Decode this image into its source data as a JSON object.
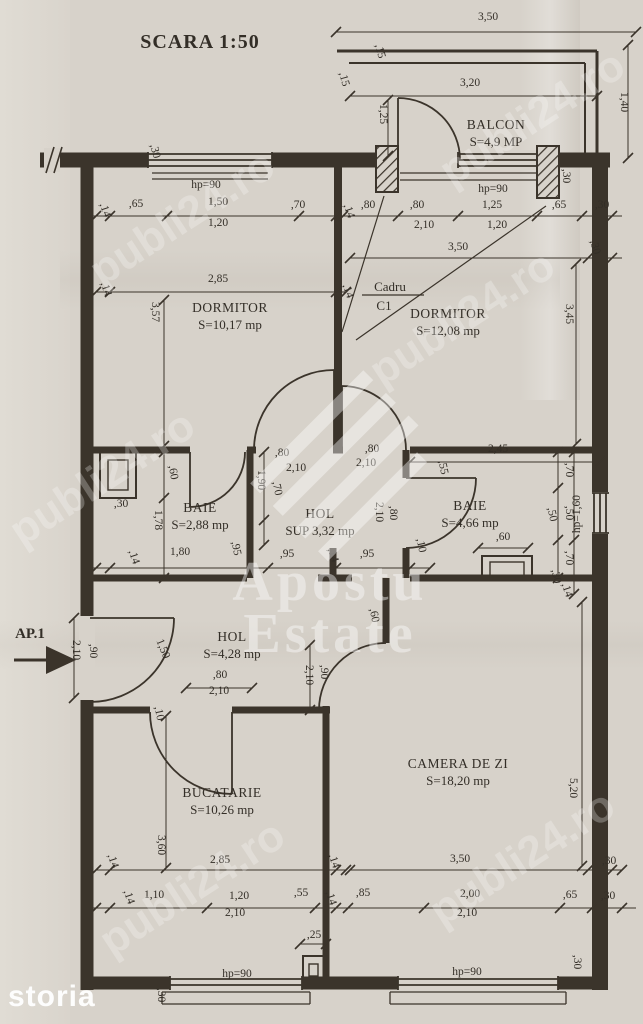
{
  "title": "SCARA 1:50",
  "entrance": {
    "label": "AP.1"
  },
  "frame_callout": {
    "line1": "Cadru",
    "line2": "C1"
  },
  "watermarks": {
    "portal": "publi24.ro",
    "agency_line1": "Apostu",
    "agency_line2": "Estate",
    "footer": "storia"
  },
  "colors": {
    "ink": "#3b342b",
    "paper": "#d7d2ca",
    "watermark": "#ffffff"
  },
  "rooms": [
    {
      "id": "balcon",
      "name": "BALCON",
      "area": "S=4,9 MP",
      "x": 496,
      "y": 129
    },
    {
      "id": "dormitor-1",
      "name": "DORMITOR",
      "area": "S=10,17 mp",
      "x": 230,
      "y": 312
    },
    {
      "id": "dormitor-2",
      "name": "DORMITOR",
      "area": "S=12,08 mp",
      "x": 448,
      "y": 318
    },
    {
      "id": "baie-1",
      "name": "BAIE",
      "area": "S=2,88 mp",
      "x": 200,
      "y": 512
    },
    {
      "id": "hol-1",
      "name": "HOL",
      "area": "SUP 3,32 mp",
      "x": 320,
      "y": 518
    },
    {
      "id": "baie-2",
      "name": "BAIE",
      "area": "S=4,66 mp",
      "x": 470,
      "y": 510
    },
    {
      "id": "hol-2",
      "name": "HOL",
      "area": "S=4,28 mp",
      "x": 232,
      "y": 641
    },
    {
      "id": "bucatarie",
      "name": "BUCATARIE",
      "area": "S=10,26 mp",
      "x": 222,
      "y": 797
    },
    {
      "id": "camera-de-zi",
      "name": "CAMERA DE ZI",
      "area": "S=18,20 mp",
      "x": 458,
      "y": 768
    }
  ],
  "dim_labels": [
    {
      "text": "3,50",
      "x": 488,
      "y": 20,
      "rot": 0
    },
    {
      "text": "1,40",
      "x": 621,
      "y": 102,
      "rot": 90
    },
    {
      "text": "3,20",
      "x": 470,
      "y": 86,
      "rot": 0
    },
    {
      "text": "1,25",
      "x": 380,
      "y": 114,
      "rot": 90
    },
    {
      "text": ",15",
      "x": 377,
      "y": 52,
      "rot": 75
    },
    {
      "text": ",15",
      "x": 341,
      "y": 80,
      "rot": 75
    },
    {
      "text": "hp=90",
      "x": 493,
      "y": 192,
      "rot": 0
    },
    {
      "text": "hp=90",
      "x": 206,
      "y": 188,
      "rot": 0
    },
    {
      "text": ",30",
      "x": 563,
      "y": 176,
      "rot": 90
    },
    {
      "text": ",30",
      "x": 152,
      "y": 152,
      "rot": 75
    },
    {
      "text": ",14",
      "x": 102,
      "y": 211,
      "rot": 72
    },
    {
      "text": ",65",
      "x": 136,
      "y": 207,
      "rot": 0
    },
    {
      "text": "1,50",
      "x": 218,
      "y": 205,
      "rot": 0
    },
    {
      "text": "1,20",
      "x": 218,
      "y": 226,
      "rot": 0
    },
    {
      "text": ",70",
      "x": 298,
      "y": 208,
      "rot": 0
    },
    {
      "text": ",14",
      "x": 346,
      "y": 212,
      "rot": 72
    },
    {
      "text": ",80",
      "x": 368,
      "y": 208,
      "rot": 0
    },
    {
      "text": ",80",
      "x": 417,
      "y": 208,
      "rot": 0
    },
    {
      "text": "2,10",
      "x": 424,
      "y": 228,
      "rot": 0
    },
    {
      "text": "1,25",
      "x": 492,
      "y": 208,
      "rot": 0
    },
    {
      "text": "1,20",
      "x": 497,
      "y": 228,
      "rot": 0
    },
    {
      "text": ",65",
      "x": 559,
      "y": 208,
      "rot": 0
    },
    {
      "text": ",30",
      "x": 602,
      "y": 208,
      "rot": 0
    },
    {
      "text": ",14",
      "x": 103,
      "y": 290,
      "rot": 72
    },
    {
      "text": "2,85",
      "x": 218,
      "y": 282,
      "rot": 0
    },
    {
      "text": ",14",
      "x": 345,
      "y": 292,
      "rot": 72
    },
    {
      "text": "3,50",
      "x": 458,
      "y": 250,
      "rot": 0
    },
    {
      "text": ",30",
      "x": 592,
      "y": 248,
      "rot": 75
    },
    {
      "text": "3,57",
      "x": 152,
      "y": 312,
      "rot": 90
    },
    {
      "text": "3,45",
      "x": 566,
      "y": 314,
      "rot": 90
    },
    {
      "text": ",60",
      "x": 170,
      "y": 473,
      "rot": 80
    },
    {
      "text": ",30",
      "x": 121,
      "y": 507,
      "rot": 0
    },
    {
      "text": "1,78",
      "x": 155,
      "y": 520,
      "rot": 90
    },
    {
      "text": ",14",
      "x": 131,
      "y": 558,
      "rot": 72
    },
    {
      "text": "1,80",
      "x": 180,
      "y": 555,
      "rot": 0
    },
    {
      "text": ",95",
      "x": 233,
      "y": 549,
      "rot": 78
    },
    {
      "text": ",95",
      "x": 287,
      "y": 557,
      "rot": 0
    },
    {
      "text": ",14",
      "x": 330,
      "y": 556,
      "rot": 72
    },
    {
      "text": ",95",
      "x": 367,
      "y": 557,
      "rot": 0
    },
    {
      "text": ",10",
      "x": 418,
      "y": 546,
      "rot": 78
    },
    {
      "text": "1,90",
      "x": 258,
      "y": 480,
      "rot": 90
    },
    {
      "text": ",70",
      "x": 274,
      "y": 489,
      "rot": 78
    },
    {
      "text": ",80",
      "x": 282,
      "y": 456,
      "rot": 0
    },
    {
      "text": "2,10",
      "x": 296,
      "y": 471,
      "rot": 0
    },
    {
      "text": ",80",
      "x": 372,
      "y": 452,
      "rot": 0
    },
    {
      "text": "2,10",
      "x": 366,
      "y": 466,
      "rot": 0
    },
    {
      "text": "2,45",
      "x": 498,
      "y": 452,
      "rot": 0
    },
    {
      "text": ",55",
      "x": 440,
      "y": 468,
      "rot": 78
    },
    {
      "text": ",70",
      "x": 566,
      "y": 470,
      "rot": 90
    },
    {
      "text": ",50",
      "x": 549,
      "y": 515,
      "rot": 78
    },
    {
      "text": ",50",
      "x": 566,
      "y": 513,
      "rot": 90
    },
    {
      "text": "hp=1,60",
      "x": 580,
      "y": 514,
      "rot": -90
    },
    {
      "text": ",80",
      "x": 390,
      "y": 513,
      "rot": 90
    },
    {
      "text": "2,10",
      "x": 376,
      "y": 512,
      "rot": 90
    },
    {
      "text": ",60",
      "x": 503,
      "y": 540,
      "rot": 0
    },
    {
      "text": ",70",
      "x": 566,
      "y": 558,
      "rot": 90
    },
    {
      "text": ",30",
      "x": 553,
      "y": 577,
      "rot": 78
    },
    {
      "text": ",14",
      "x": 564,
      "y": 591,
      "rot": 72
    },
    {
      "text": ",90",
      "x": 90,
      "y": 651,
      "rot": 90
    },
    {
      "text": "2,10",
      "x": 73,
      "y": 650,
      "rot": 90
    },
    {
      "text": "1,50",
      "x": 160,
      "y": 650,
      "rot": 68
    },
    {
      "text": ",80",
      "x": 220,
      "y": 678,
      "rot": 0
    },
    {
      "text": "2,10",
      "x": 219,
      "y": 694,
      "rot": 0
    },
    {
      "text": ",60",
      "x": 371,
      "y": 616,
      "rot": 78
    },
    {
      "text": ",90",
      "x": 321,
      "y": 672,
      "rot": 90
    },
    {
      "text": "2,10",
      "x": 306,
      "y": 675,
      "rot": 90
    },
    {
      "text": ",10",
      "x": 156,
      "y": 714,
      "rot": 78
    },
    {
      "text": "3,60",
      "x": 158,
      "y": 845,
      "rot": 90
    },
    {
      "text": "5,20",
      "x": 570,
      "y": 788,
      "rot": 90
    },
    {
      "text": ",14",
      "x": 110,
      "y": 862,
      "rot": 72
    },
    {
      "text": "2,85",
      "x": 220,
      "y": 863,
      "rot": 0
    },
    {
      "text": ",14",
      "x": 331,
      "y": 862,
      "rot": 72
    },
    {
      "text": "3,50",
      "x": 460,
      "y": 862,
      "rot": 0
    },
    {
      "text": ",30",
      "x": 609,
      "y": 864,
      "rot": 0
    },
    {
      "text": ",14",
      "x": 126,
      "y": 898,
      "rot": 72
    },
    {
      "text": "1,10",
      "x": 154,
      "y": 898,
      "rot": 0
    },
    {
      "text": "1,20",
      "x": 239,
      "y": 899,
      "rot": 0
    },
    {
      "text": "2,10",
      "x": 235,
      "y": 916,
      "rot": 0
    },
    {
      "text": ",55",
      "x": 301,
      "y": 896,
      "rot": 0
    },
    {
      "text": ",14",
      "x": 328,
      "y": 899,
      "rot": 72
    },
    {
      "text": ",85",
      "x": 363,
      "y": 896,
      "rot": 0
    },
    {
      "text": "2,00",
      "x": 470,
      "y": 897,
      "rot": 0
    },
    {
      "text": "2,10",
      "x": 467,
      "y": 916,
      "rot": 0
    },
    {
      "text": ",65",
      "x": 570,
      "y": 898,
      "rot": 0
    },
    {
      "text": ",30",
      "x": 608,
      "y": 899,
      "rot": 0
    },
    {
      "text": ",25",
      "x": 314,
      "y": 938,
      "rot": 0
    },
    {
      "text": "hp=90",
      "x": 237,
      "y": 977,
      "rot": 0
    },
    {
      "text": "hp=90",
      "x": 467,
      "y": 975,
      "rot": 0
    },
    {
      "text": ",30",
      "x": 158,
      "y": 995,
      "rot": 90
    },
    {
      "text": ",30",
      "x": 574,
      "y": 962,
      "rot": 90
    }
  ]
}
